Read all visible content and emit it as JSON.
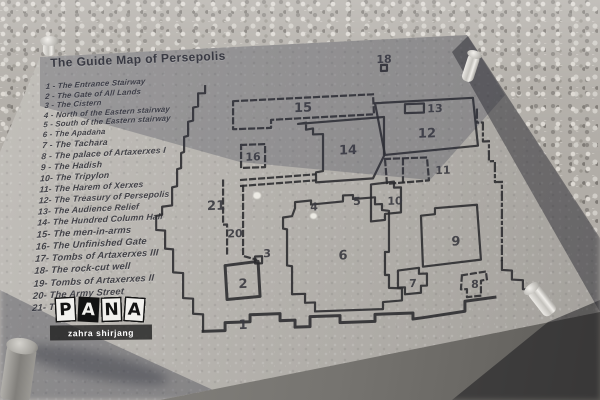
{
  "title": "The Guide Map of Persepolis",
  "legend_items": [
    "1 - The Entrance Stairway",
    "2 - The Gate of All Lands",
    "3 - The Cistern",
    "4 - North of the Eastern stairway",
    "5 - South of the Eastern stairway",
    "6 - The Apadana",
    "7 - The Tachara",
    "8 - The palace of Artaxerxes I",
    "9 - The Hadish",
    "10- The Tripylon",
    "11- The Harem of Xerxes",
    "12- The Treasury of Persepolis",
    "13- The Audience Relief",
    "14- The Hundred Column Hall",
    "15- The men-in-arms",
    "16- The Unfinished Gate",
    "17- Tombs of Artaxerxes III",
    "18- The rock-cut well",
    "19- Tombs of Artaxerxes II",
    "20- The Army Street",
    "21- The e"
  ],
  "map_labels": {
    "r1": "1",
    "r2": "2",
    "r3": "3",
    "r4": "4",
    "r5": "5",
    "r6": "6",
    "r7": "7",
    "r8": "8",
    "r9": "9",
    "r10": "10",
    "r11": "11",
    "r12": "12",
    "r13": "13",
    "r14": "14",
    "r15": "15",
    "r16": "16",
    "r18": "18",
    "r20": "20",
    "r21": "21"
  },
  "watermark": {
    "letters": {
      "l1": "P",
      "l2": "A",
      "l3": "N",
      "l4": "A"
    },
    "credit": "zahra shirjang"
  },
  "colors": {
    "stone": "#b5b2ad",
    "engraving": "#3b3b41",
    "map_line": "#2a2a2e",
    "gravel": "#b1ada7",
    "watermark_band": "#1c1c1c",
    "tile_dark": "#121212",
    "tile_light": "#f2f1ee"
  }
}
